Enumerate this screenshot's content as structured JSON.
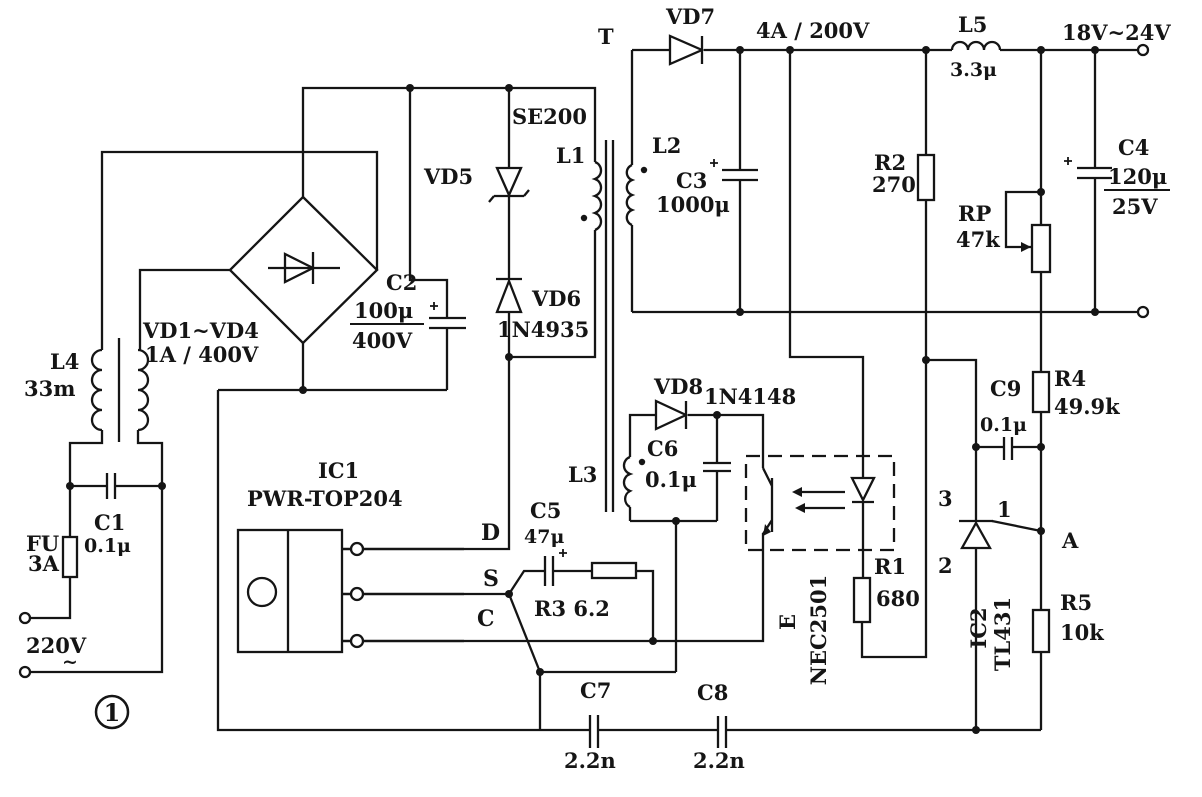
{
  "colors": {
    "ink": "#151515",
    "paper": "#ffffff"
  },
  "figure_number": "1",
  "labels": {
    "t": "T",
    "vd7": "VD7",
    "out_rating": "4A / 200V",
    "l5": "L5",
    "l5_value": "3.3μ",
    "output_range": "18V~24V",
    "se200": "SE200",
    "vd5": "VD5",
    "l1": "L1",
    "l2": "L2",
    "c3": "C3",
    "c3_value": "1000μ",
    "r2": "R2",
    "r2_value": "270",
    "rp": "RP",
    "rp_value": "47k",
    "c4": "C4",
    "c4_capacitance": "120μ",
    "c4_voltage": "25V",
    "c2": "C2",
    "c2_capacitance": "100μ",
    "c2_voltage": "400V",
    "vd6": "VD6",
    "vd6_part": "1N4935",
    "l4": "L4",
    "l4_value": "33m",
    "bridge_name": "VD1~VD4",
    "bridge_rating": "1A / 400V",
    "vd8": "VD8",
    "vd8_part": "1N4148",
    "c6": "C6",
    "c6_value": "0.1μ",
    "l3": "L3",
    "c9": "C9",
    "c9_value": "0.1μ",
    "r4": "R4",
    "r4_value": "49.9k",
    "ic1": "IC1",
    "ic1_part": "PWR-TOP204",
    "pin_d": "D",
    "pin_s": "S",
    "pin_c": "C",
    "c5": "C5",
    "c5_value": "47μ",
    "r3": "R3 6.2",
    "fu": "FU",
    "fu_value": "3A",
    "c1": "C1",
    "c1_value": "0.1μ",
    "mains": "220V",
    "mains_tilde": "~",
    "opto_e": "E",
    "opto_part": "NEC2501",
    "r1": "R1",
    "r1_value": "680",
    "tl431_pin3": "3",
    "tl431_pin2": "2",
    "tl431_pin1": "1",
    "tl431_a": "A",
    "ic2": "IC2",
    "ic2_part": "TL431",
    "r5": "R5",
    "r5_value": "10k",
    "c7": "C7",
    "c7_value": "2.2n",
    "c8": "C8",
    "c8_value": "2.2n"
  }
}
